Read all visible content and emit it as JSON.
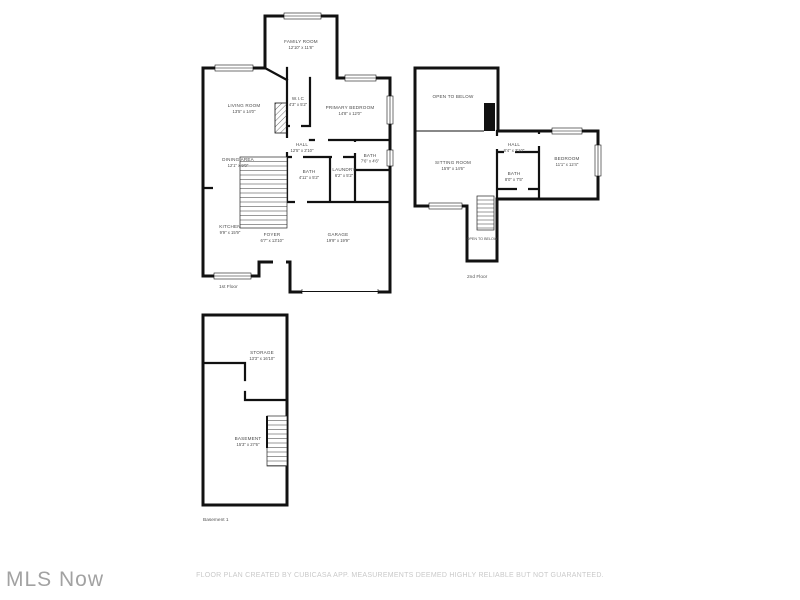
{
  "watermark": "MLS Now",
  "disclaimer": "FLOOR PLAN CREATED BY CUBICASA APP. MEASUREMENTS DEEMED HIGHLY RELIABLE BUT NOT GUARANTEED.",
  "colors": {
    "wall": "#111111",
    "room_label": "#4a4a4a",
    "disclaimer_text": "#c9c9c9",
    "watermark_text": "#a2a2a2"
  },
  "floors": {
    "first": {
      "label": "1st Floor",
      "rooms": {
        "family_room": {
          "name": "FAMILY ROOM",
          "dims": "12'10\" x 11'8\""
        },
        "living_room": {
          "name": "LIVING ROOM",
          "dims": "13'5\" x 14'0\""
        },
        "wic": {
          "name": "W.I.C",
          "dims": "4'3\" x 5'2\""
        },
        "primary_bedroom": {
          "name": "PRIMARY BEDROOM",
          "dims": "14'8\" x 12'0\""
        },
        "dining_area": {
          "name": "DINING AREA",
          "dims": "12'1\" x 9'0\""
        },
        "hall": {
          "name": "HALL",
          "dims": "12'5\" x 2'10\""
        },
        "bath": {
          "name": "BATH",
          "dims": "4'11\" x 5'2\""
        },
        "laundry": {
          "name": "LAUNDRY",
          "dims": "6'2\" x 5'2\""
        },
        "bath2": {
          "name": "BATH",
          "dims": "7'6\" x 4'6\""
        },
        "kitchen": {
          "name": "KITCHEN",
          "dims": "9'9\" x 15'9\""
        },
        "foyer": {
          "name": "FOYER",
          "dims": "6'7\" x 13'10\""
        },
        "garage": {
          "name": "GARAGE",
          "dims": "19'9\" x 19'9\""
        }
      }
    },
    "second": {
      "label": "2nd Floor",
      "rooms": {
        "open_to_below": {
          "name": "OPEN TO BELOW"
        },
        "sitting_room": {
          "name": "SITTING ROOM",
          "dims": "15'9\" x 14'6\""
        },
        "hall": {
          "name": "HALL",
          "dims": "8'4\" x 2'10\""
        },
        "bath": {
          "name": "BATH",
          "dims": "8'0\" x 7'5\""
        },
        "bedroom": {
          "name": "BEDROOM",
          "dims": "11'1\" x 12'4\""
        },
        "open_to_below2": {
          "name": "OPEN TO BELOW"
        }
      }
    },
    "basement": {
      "label": "Basement 1",
      "rooms": {
        "storage": {
          "name": "STORAGE",
          "dims": "13'3\" x 16'10\""
        },
        "basement": {
          "name": "BASEMENT",
          "dims": "15'3\" x 27'6\""
        }
      }
    }
  }
}
